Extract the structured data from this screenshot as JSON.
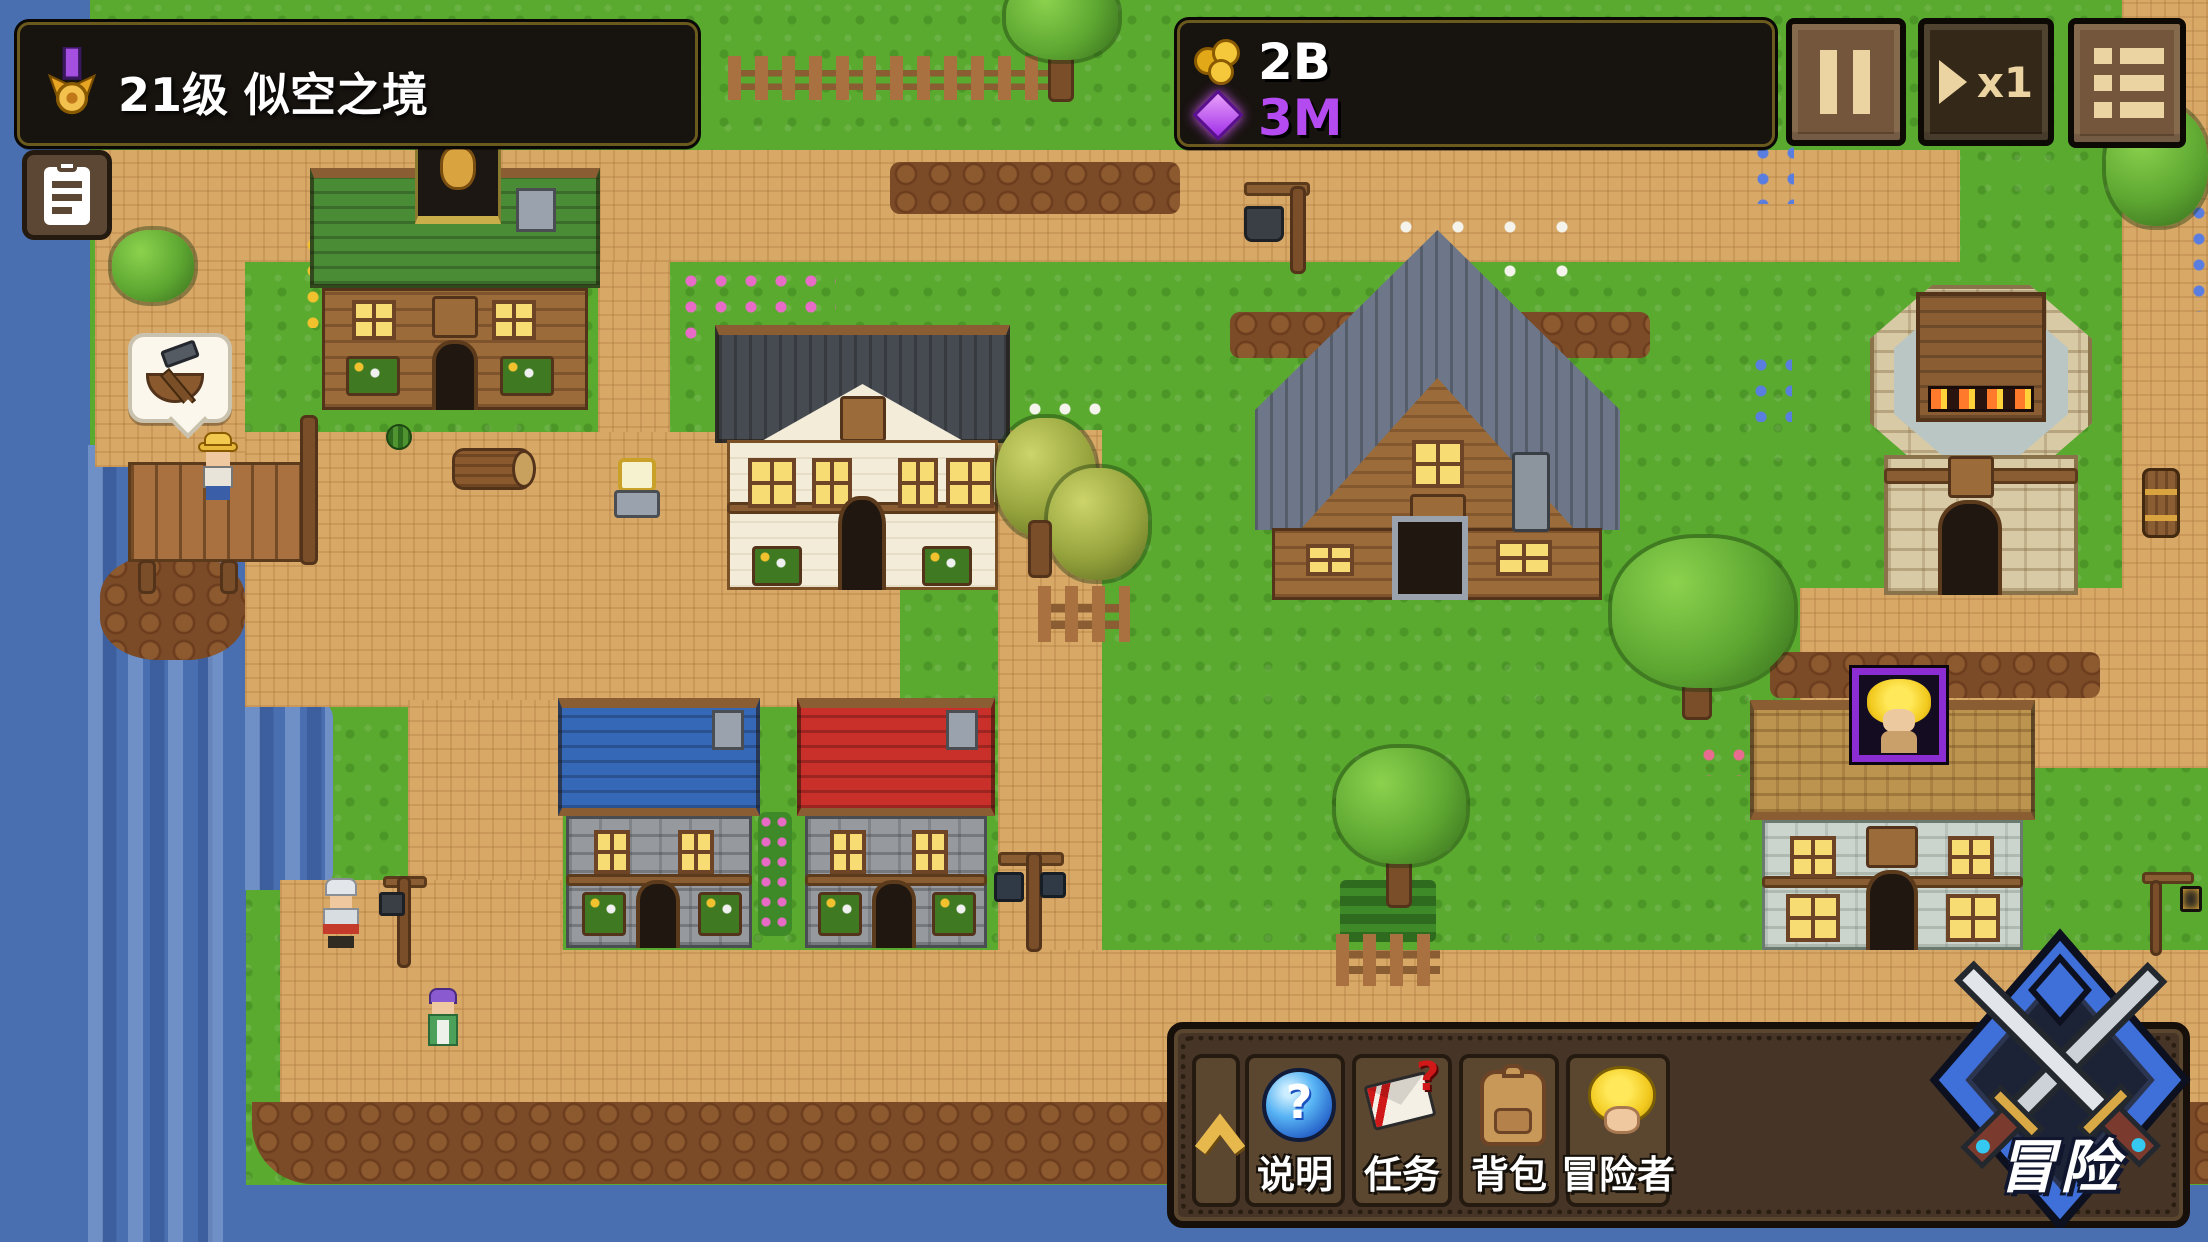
{
  "header": {
    "level_banner": {
      "icon": "medal-icon",
      "label": "21级 似空之境"
    },
    "quest_log_button": {
      "icon": "clipboard-icon"
    },
    "currency_panel": {
      "gold": {
        "icon": "gold-coins-icon",
        "value": "2B"
      },
      "gems": {
        "icon": "purple-crystal-icon",
        "value": "3M"
      }
    },
    "pause_button": {
      "icon": "pause-icon"
    },
    "speed_button": {
      "icon": "play-icon",
      "label": "x1"
    },
    "menu_button": {
      "icon": "list-menu-icon"
    }
  },
  "bottom_bar": {
    "collapse_button": {
      "icon": "chevron-up-icon"
    },
    "buttons": [
      {
        "id": "help",
        "icon": "question-orb-icon",
        "label": "说明",
        "glyph": "?"
      },
      {
        "id": "quests",
        "icon": "envelope-question-icon",
        "label": "任务",
        "glyph": "?"
      },
      {
        "id": "backpack",
        "icon": "backpack-icon",
        "label": "背包"
      },
      {
        "id": "adventurers",
        "icon": "adventurer-head-icon",
        "label": "冒险者"
      }
    ]
  },
  "adventure_button": {
    "icon": "crossed-swords-emblem-icon",
    "label": "冒险"
  },
  "map": {
    "speech_bubble": {
      "icon": "boat-and-hammer-icon"
    },
    "selection_portrait": {
      "icon": "blond-adventurer-portrait"
    }
  },
  "palette": {
    "panel_dark": "#17130f",
    "panel_border_gold": "#6b5a1e",
    "accent_gold": "#e7b94c",
    "gem_purple": "#b44bf0",
    "wood_brown": "#5b4630",
    "water_blue": "#4a6fb0",
    "grass_green": "#5aaa30",
    "path_tan": "#d8a867"
  }
}
